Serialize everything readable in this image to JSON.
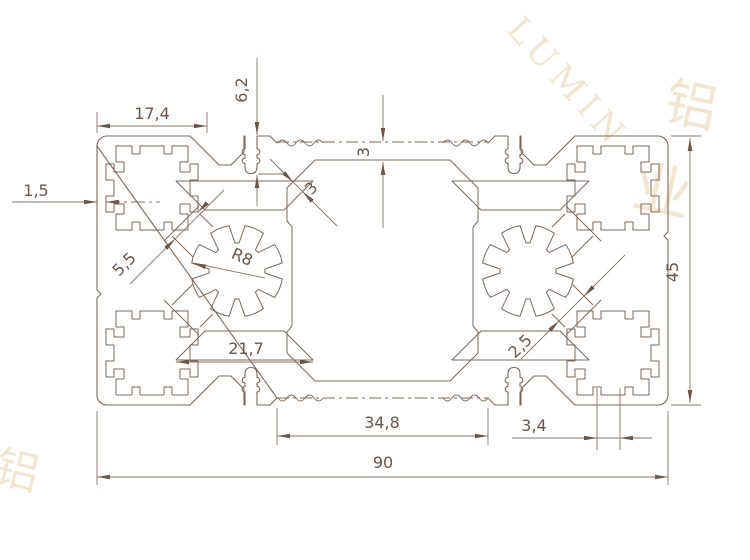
{
  "colors": {
    "line": "#7c685a",
    "dim": "#8a7265",
    "text": "#6b564a",
    "watermark": "#f2e6d3",
    "background": "#ffffff"
  },
  "dims": {
    "d17": {
      "label": "17,4"
    },
    "d62": {
      "label": "6,2"
    },
    "d3top": {
      "label": "3"
    },
    "d15": {
      "label": "1,5"
    },
    "d55": {
      "label": "5,5"
    },
    "r8": {
      "label": "R8"
    },
    "d217": {
      "label": "21,7"
    },
    "d3diag": {
      "label": "3"
    },
    "d45": {
      "label": "45"
    },
    "d25": {
      "label": "2,5"
    },
    "d34": {
      "label": "3,4"
    },
    "d348": {
      "label": "34,8"
    },
    "d90": {
      "label": "90"
    }
  },
  "watermark": {
    "latin": "LUMIN",
    "cjk": "铝",
    "cjk2": "业"
  }
}
